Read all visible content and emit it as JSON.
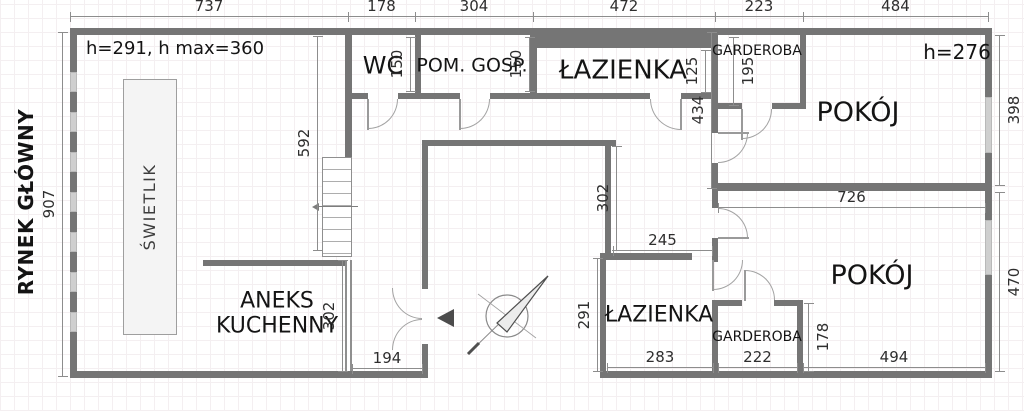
{
  "street_label": "RYNEK GŁÓWNY",
  "notes": {
    "main_height": "h=291, h max=360",
    "pokoj_top_height": "h=276"
  },
  "rooms": {
    "wc": "WC",
    "pom_gosp": "POM. GOSP.",
    "lazienka_top": "ŁAZIENKA",
    "garderoba_top": "GARDEROBA",
    "pokoj_top": "POKÓJ",
    "swietlik": "ŚWIETLIK",
    "aneks_kuchenny": "ANEKS\nKUCHENNY",
    "lazienka_bottom": "ŁAZIENKA",
    "garderoba_bottom": "GARDEROBA",
    "pokoj_bottom": "POKÓJ"
  },
  "dims": {
    "top": [
      "737",
      "178",
      "304",
      "472",
      "223",
      "484"
    ],
    "left": "907",
    "right_top": "398",
    "right_bottom": "470",
    "hall_v": "592",
    "wc_h": "150",
    "pom_h": "150",
    "laz_top_h": "125",
    "gard_top_h": "195",
    "void_h": "302",
    "corridor_h": "434",
    "rooms_w": "726",
    "hall_w": "245",
    "aneks_h": "302",
    "entrance_w": "194",
    "laz_b_h": "291",
    "laz_b_w": "283",
    "gard_b_w": "222",
    "gard_b_h": "178",
    "pokoj_b_w": "494"
  },
  "icons": {
    "compass": "north-arrow",
    "entrance": "entrance-direction-arrow"
  },
  "colors": {
    "wall": "#757575",
    "window": "#cfcfcf",
    "dim_text": "#2e2e2e",
    "skylight_fill": "#f4f4f4"
  }
}
